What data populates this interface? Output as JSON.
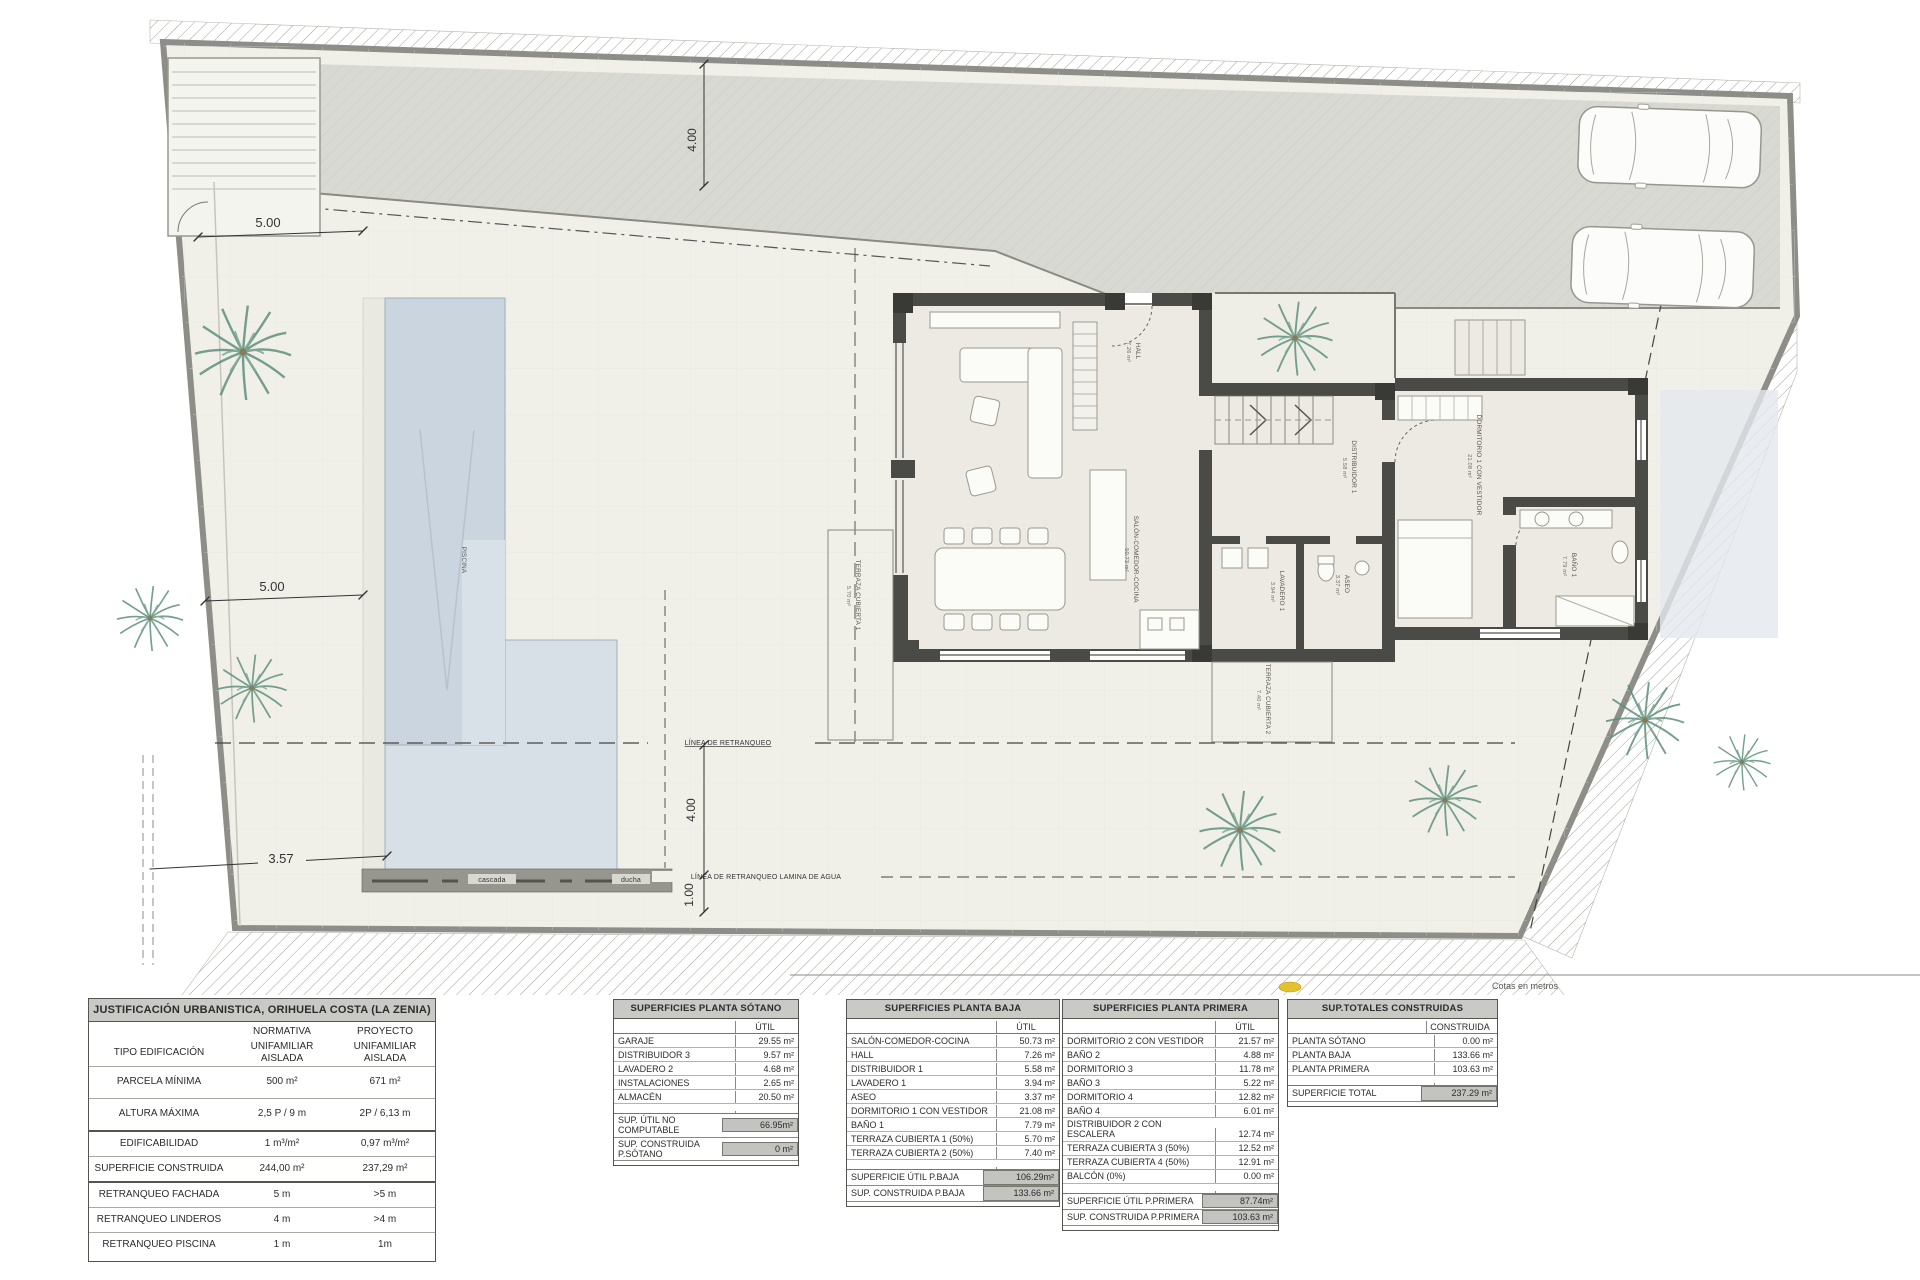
{
  "plan": {
    "dims": {
      "front_left": "5.00",
      "side_left": "5.00",
      "road_depth": "4.00",
      "rear": "4.00",
      "pool_edge": "1.00",
      "pool_offset": "3.57",
      "side_right": "4.00"
    },
    "lines": {
      "retranqueo": "LÍNEA DE RETRANQUEO",
      "retranqueo_agua": "LÍNEA DE RETRANQUEO LAMINA DE AGUA"
    },
    "pool": {
      "name": "PISCINA",
      "cascada": "cascada",
      "ducha": "ducha"
    },
    "rooms": {
      "hall": {
        "name": "HALL",
        "area": "7.26 m²"
      },
      "salon": {
        "name": "SALÓN-COMEDOR-COCINA",
        "area": "50.73 m²"
      },
      "distribuidor": {
        "name": "DISTRIBUIDOR 1",
        "area": "5.58 m²"
      },
      "aseo": {
        "name": "ASEO",
        "area": "3.37 m²"
      },
      "lavadero": {
        "name": "LAVADERO 1",
        "area": "3.94 m²"
      },
      "dormitorio": {
        "name": "DORMITORIO 1 CON VESTIDOR",
        "area": "21.08 m²"
      },
      "bano": {
        "name": "BAÑO 1",
        "area": "7.79 m²"
      },
      "terraza1": {
        "name": "TERRAZA CUBIERTA 1",
        "area": "5.70 m²"
      },
      "terraza2": {
        "name": "TERRAZA CUBIERTA 2",
        "area": "7.40 m²"
      }
    },
    "note": "Cotas en metros",
    "colors": {
      "pool": "#cbd5e0",
      "walls": "#4a4a46",
      "marker_yellow": "#e2c22e",
      "plot": "#f0efe8"
    }
  },
  "tables": {
    "urbanistica": {
      "title": "JUSTIFICACIÓN URBANISTICA, ORIHUELA COSTA (LA ZENIA)",
      "header": {
        "normativa": "NORMATIVA",
        "proyecto": "PROYECTO"
      },
      "rows": [
        {
          "label": "TIPO EDIFICACIÓN",
          "normativa": "UNIFAMILIAR AISLADA",
          "proyecto": "UNIFAMILIAR AISLADA"
        },
        {
          "label": "PARCELA MÍNIMA",
          "normativa": "500 m²",
          "proyecto": "671 m²"
        },
        {
          "label": "ALTURA MÁXIMA",
          "normativa": "2,5 P / 9 m",
          "proyecto": "2P / 6,13 m"
        },
        {
          "label": "EDIFICABILIDAD",
          "normativa": "1 m³/m²",
          "proyecto": "0,97 m³/m²"
        },
        {
          "label": "SUPERFICIE CONSTRUIDA",
          "normativa": "244,00 m²",
          "proyecto": "237,29 m²"
        },
        {
          "label": "RETRANQUEO FACHADA",
          "normativa": "5 m",
          "proyecto": ">5 m"
        },
        {
          "label": "RETRANQUEO LINDEROS",
          "normativa": "4 m",
          "proyecto": ">4 m"
        },
        {
          "label": "RETRANQUEO PISCINA",
          "normativa": "1 m",
          "proyecto": "1m"
        }
      ]
    },
    "sotano": {
      "title": "SUPERFICIES PLANTA SÓTANO",
      "col": "ÚTIL",
      "rows": [
        {
          "label": "GARAJE",
          "value": "29.55 m²"
        },
        {
          "label": "DISTRIBUIDOR 3",
          "value": "9.57 m²"
        },
        {
          "label": "LAVADERO 2",
          "value": "4.68 m²"
        },
        {
          "label": "INSTALACIONES",
          "value": "2.65 m²"
        },
        {
          "label": "ALMACÉN",
          "value": "20.50 m²"
        }
      ],
      "totals": [
        {
          "label": "SUP. ÚTIL NO COMPUTABLE",
          "value": "66.95m²"
        },
        {
          "label": "SUP. CONSTRUIDA P.SÓTANO",
          "value": "0 m²"
        }
      ]
    },
    "baja": {
      "title": "SUPERFICIES PLANTA BAJA",
      "col": "ÚTIL",
      "rows": [
        {
          "label": "SALÓN-COMEDOR-COCINA",
          "value": "50.73 m²"
        },
        {
          "label": "HALL",
          "value": "7.26 m²"
        },
        {
          "label": "DISTRIBUIDOR 1",
          "value": "5.58 m²"
        },
        {
          "label": "LAVADERO 1",
          "value": "3.94 m²"
        },
        {
          "label": "ASEO",
          "value": "3.37 m²"
        },
        {
          "label": "DORMITORIO 1 CON VESTIDOR",
          "value": "21.08 m²"
        },
        {
          "label": "BAÑO 1",
          "value": "7.79 m²"
        },
        {
          "label": "TERRAZA CUBIERTA 1 (50%)",
          "value": "5.70 m²"
        },
        {
          "label": "TERRAZA CUBIERTA 2 (50%)",
          "value": "7.40 m²"
        }
      ],
      "totals": [
        {
          "label": "SUPERFICIE ÚTIL P.BAJA",
          "value": "106.29m²"
        },
        {
          "label": "SUP. CONSTRUIDA P.BAJA",
          "value": "133.66 m²"
        }
      ]
    },
    "primera": {
      "title": "SUPERFICIES PLANTA PRIMERA",
      "col": "ÚTIL",
      "rows": [
        {
          "label": "DORMITORIO 2 CON VESTIDOR",
          "value": "21.57 m²"
        },
        {
          "label": "BAÑO 2",
          "value": "4.88 m²"
        },
        {
          "label": "DORMITORIO 3",
          "value": "11.78 m²"
        },
        {
          "label": "BAÑO 3",
          "value": "5.22 m²"
        },
        {
          "label": "DORMITORIO 4",
          "value": "12.82 m²"
        },
        {
          "label": "BAÑO 4",
          "value": "6.01 m²"
        },
        {
          "label": "DISTRIBUIDOR 2 CON\nESCALERA",
          "value": "12.74 m²"
        },
        {
          "label": "TERRAZA CUBIERTA 3 (50%)",
          "value": "12.52 m²"
        },
        {
          "label": "TERRAZA CUBIERTA 4 (50%)",
          "value": "12.91 m²"
        },
        {
          "label": "BALCÓN (0%)",
          "value": "0.00 m²"
        }
      ],
      "totals": [
        {
          "label": "SUPERFICIE ÚTIL P.PRIMERA",
          "value": "87.74m²"
        },
        {
          "label": "SUP. CONSTRUIDA P.PRIMERA",
          "value": "103.63 m²"
        }
      ]
    },
    "totales": {
      "title": "SUP.TOTALES CONSTRUIDAS",
      "col": "CONSTRUIDA",
      "rows": [
        {
          "label": "PLANTA SÓTANO",
          "value": "0.00 m²"
        },
        {
          "label": "PLANTA BAJA",
          "value": "133.66 m²"
        },
        {
          "label": "PLANTA PRIMERA",
          "value": "103.63 m²"
        }
      ],
      "totals": [
        {
          "label": "SUPERFICIE TOTAL",
          "value": "237.29 m²"
        }
      ]
    }
  }
}
